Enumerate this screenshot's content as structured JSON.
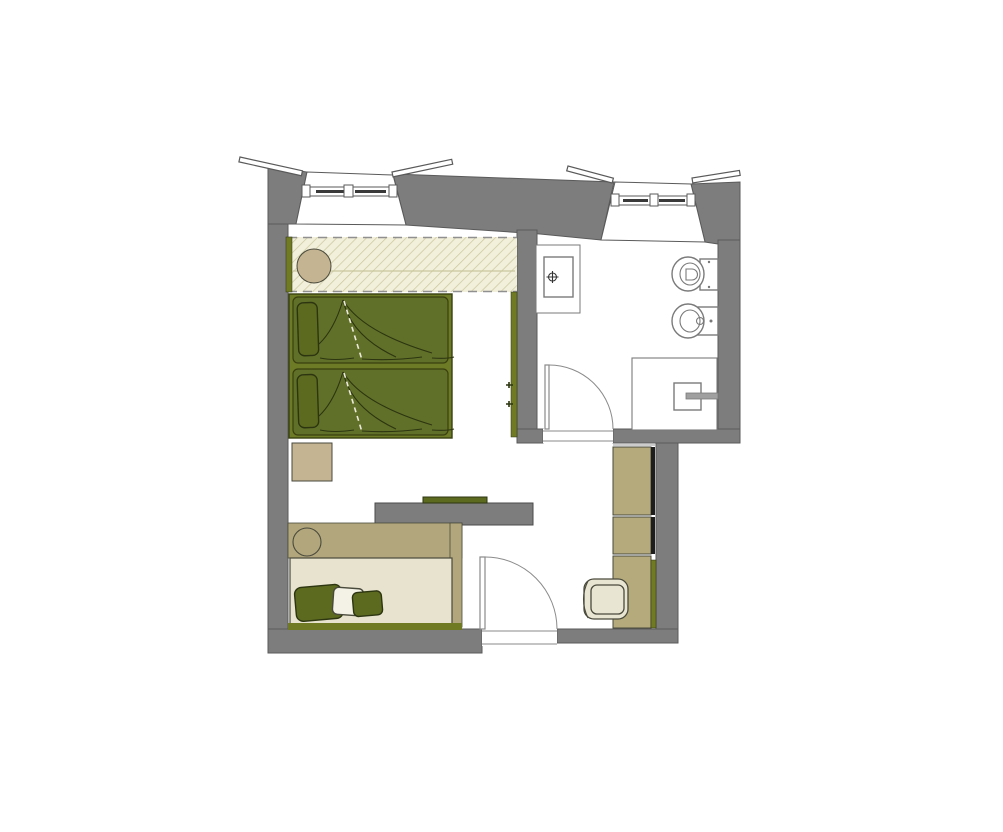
{
  "document": {
    "kind": "architectural-floor-plan",
    "description_labels": {
      "visible_text": "none"
    }
  },
  "colors": {
    "wall": "#7d7d7d",
    "wallLine": "#5a5a5a",
    "glazing": "#3a3a3a",
    "hatchBg": "#f2efdb",
    "hatchLine": "#c9c79c",
    "dash": "#909090",
    "tan": "#c4b492",
    "platform": "#b2a67c",
    "cream": "#e7e3ce",
    "chair": "#e9e5d3",
    "olive": "#617029",
    "oliveDark": "#5c6a1f",
    "bedFrame": "#6d7a26",
    "bedEdge": "#39400f",
    "baseStrip": "#6f7a22",
    "detailDark": "#2c3510",
    "duvetDash": "#eceadb",
    "cabinet": "#b5aa7c",
    "cabinetEdge": "#1d1d1d",
    "pillowWhite": "#f4f2e7",
    "outline": "#4a4a3c",
    "fixture": "#7a7a7a",
    "faucet": "#a0a0a0",
    "doorStroke": "#8a8a8a"
  },
  "plan": {
    "rooms": [
      {
        "name": "bedroom",
        "items": [
          "double-bed",
          "headboard-panel",
          "round-stool",
          "side-table",
          "tv-partition",
          "tv",
          "daybed",
          "cushions",
          "wardrobe",
          "desk",
          "desk-chair"
        ]
      },
      {
        "name": "bathroom",
        "items": [
          "shower",
          "toilet",
          "bidet",
          "vanity-washbasin"
        ]
      }
    ],
    "windows": [
      "bedroom-window",
      "bathroom-window"
    ],
    "doors": [
      "bathroom-door",
      "entrance-door"
    ]
  }
}
